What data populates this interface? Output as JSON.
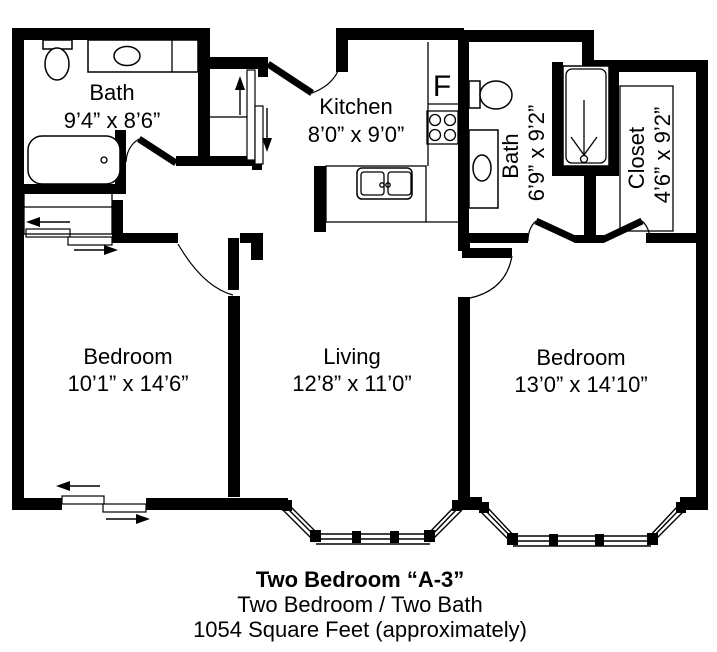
{
  "plan": {
    "background": "#ffffff",
    "wall_color": "#000000",
    "rooms": [
      {
        "id": "bath-1",
        "name": "Bath",
        "dims": "9’4” x 8’6”"
      },
      {
        "id": "kitchen",
        "name": "Kitchen",
        "dims": "8’0” x 9’0”"
      },
      {
        "id": "bath-2",
        "name": "Bath",
        "dims": "6’9” x 9’2”"
      },
      {
        "id": "closet",
        "name": "Closet",
        "dims": "4’6” x 9’2”"
      },
      {
        "id": "bedroom-1",
        "name": "Bedroom",
        "dims": "10’1” x 14’6”"
      },
      {
        "id": "living",
        "name": "Living",
        "dims": "12’8” x 11’0”"
      },
      {
        "id": "bedroom-2",
        "name": "Bedroom",
        "dims": "13’0” x 14’10”"
      }
    ],
    "appliance_labels": {
      "refrigerator": "F"
    }
  },
  "caption": {
    "title": "Two Bedroom “A-3”",
    "subtitle": "Two Bedroom / Two Bath",
    "area": "1054 Square Feet (approximately)"
  }
}
